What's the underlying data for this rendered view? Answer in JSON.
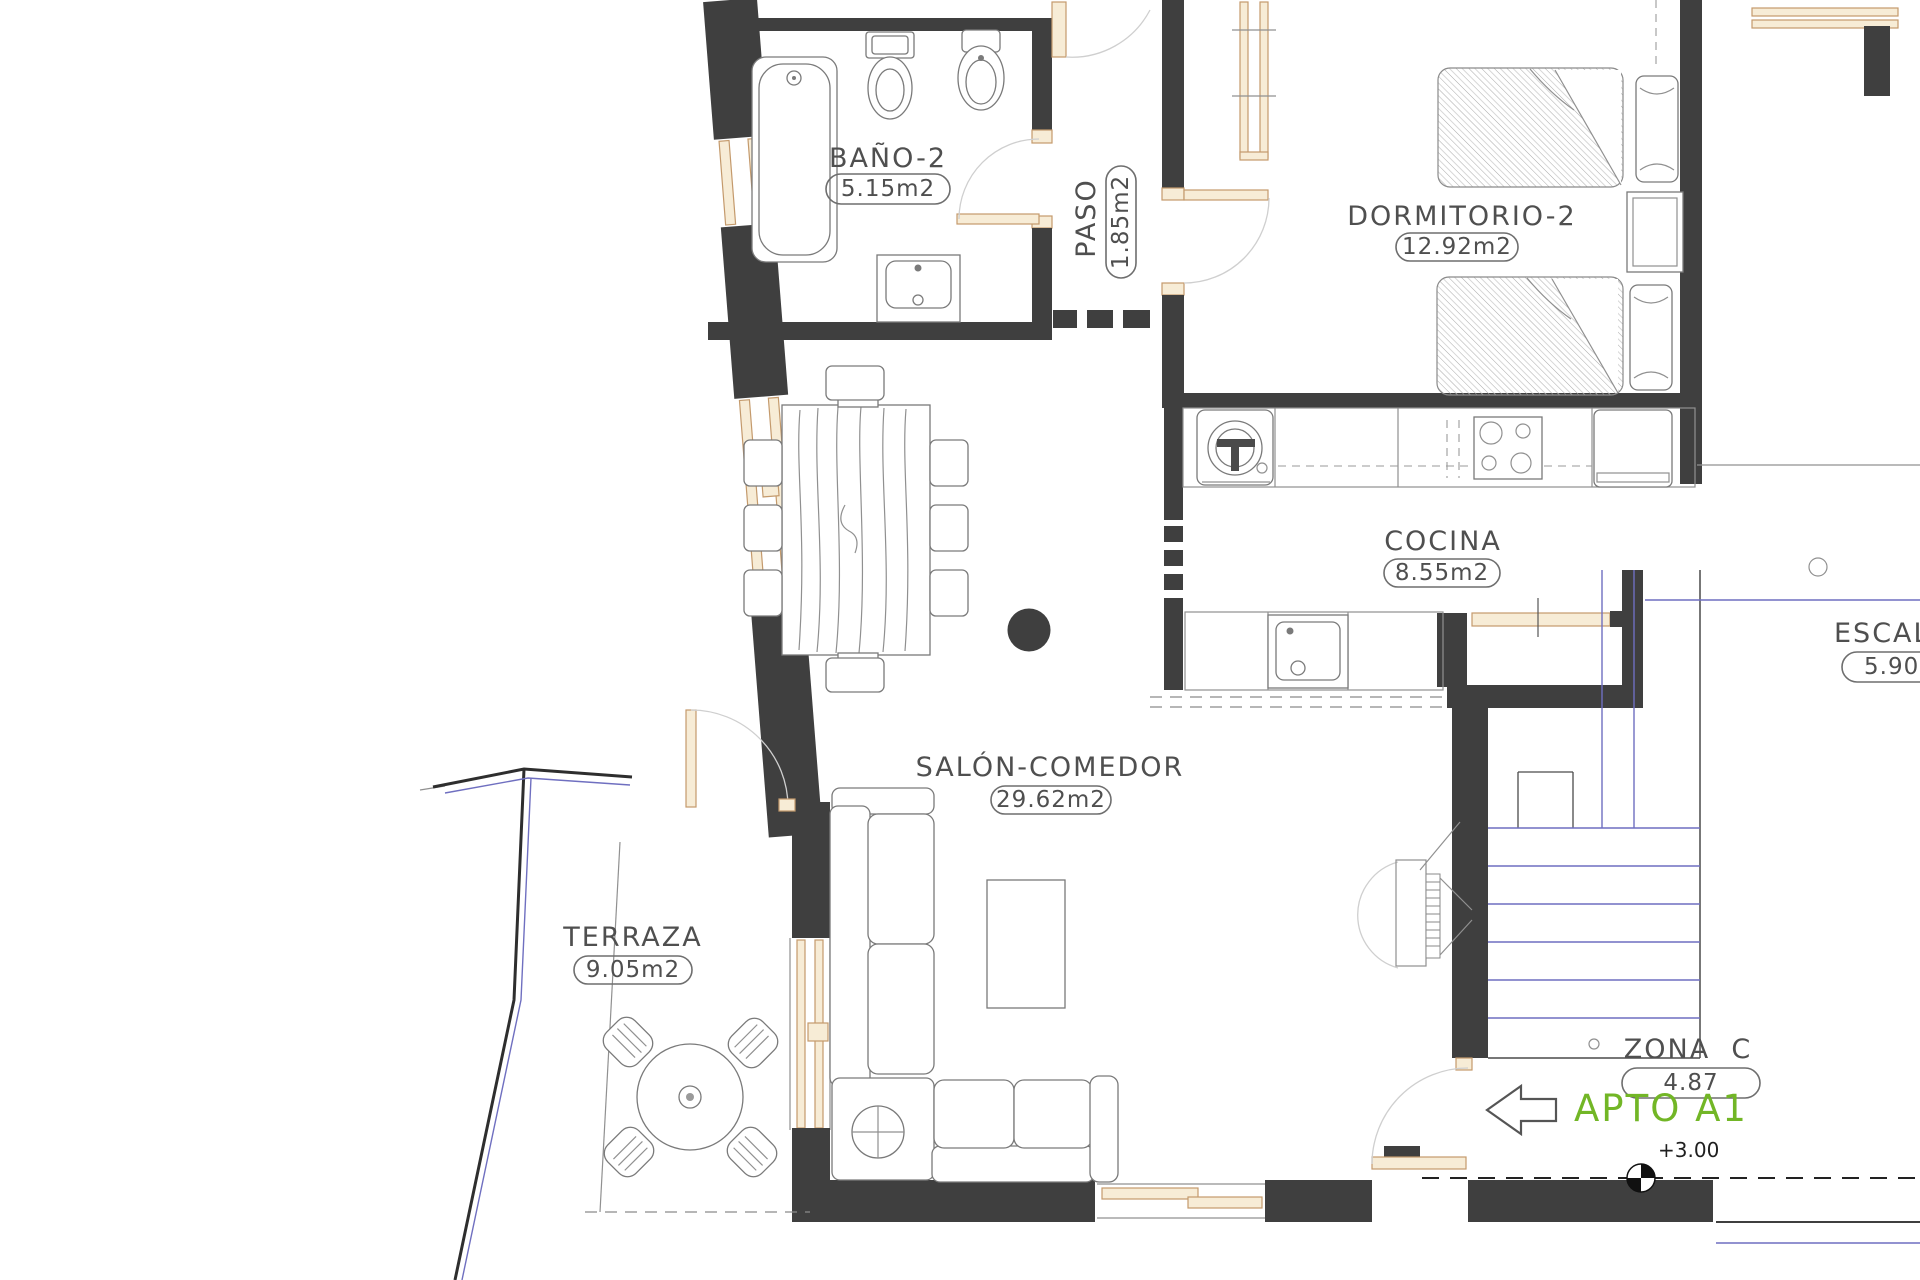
{
  "rooms": [
    {
      "name": "BAÑO-2",
      "area": "5.15m2"
    },
    {
      "name": "PASO",
      "area": "1.85m2"
    },
    {
      "name": "DORMITORIO-2",
      "area": "12.92m2"
    },
    {
      "name": "COCINA",
      "area": "8.55m2"
    },
    {
      "name": "SALÓN-COMEDOR",
      "area": "29.62m2"
    },
    {
      "name": "TERRAZA",
      "area": "9.05m2"
    },
    {
      "name": "ESCAL",
      "area": "5.90"
    },
    {
      "name": "ZONA  C",
      "area": "4.87"
    }
  ],
  "annotations": {
    "apartment_label": "APTO A1",
    "level_mark": "+3.00"
  },
  "colors": {
    "wall": "#3f3f3f",
    "tan": "#c49a6c",
    "tanFill": "#f7ecd6",
    "blue": "#6f6fc0",
    "green": "#72b626",
    "ink": "#4f4f4f",
    "line": "#909090",
    "fixture": "#7a7a7a"
  }
}
